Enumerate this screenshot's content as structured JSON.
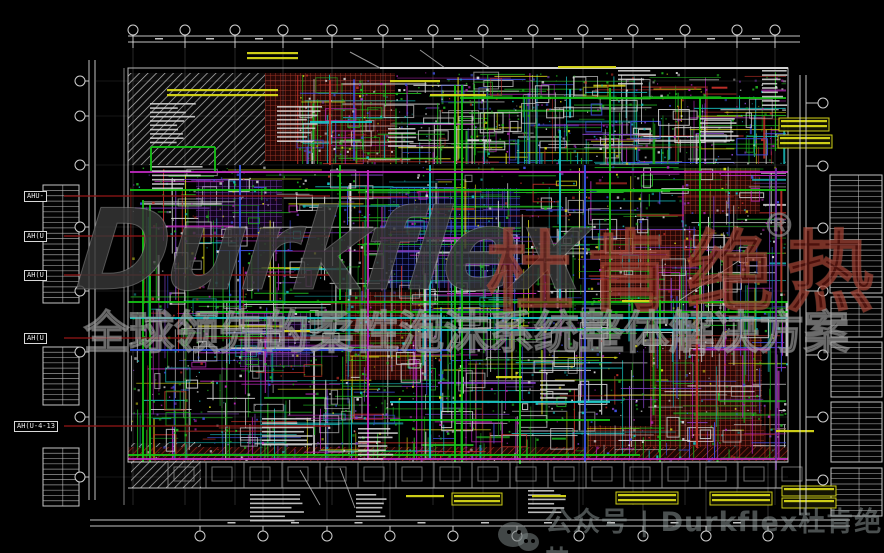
{
  "meta": {
    "width": 884,
    "height": 553,
    "background": "#000000"
  },
  "watermark": {
    "brand_latin": "Durkflex",
    "brand_cjk": "杜肯绝热",
    "registered_mark": "®",
    "slogan": "全球领先的柔性泡沫系统整体解决方案",
    "latin_color": "rgba(55,55,55,0.82)",
    "cjk_color": "rgba(125,28,20,0.60)",
    "slogan_color": "rgba(140,140,140,0.22)"
  },
  "footer": {
    "icon": "wechat-icon",
    "text": "公众号 | Durkflex杜肯绝热",
    "color": "rgba(148,158,158,0.50)"
  },
  "equipment_tags": [
    {
      "text": "AHU-",
      "x": 24,
      "y": 191
    },
    {
      "text": "AH(U",
      "x": 24,
      "y": 231
    },
    {
      "text": "AH(U",
      "x": 24,
      "y": 270
    },
    {
      "text": "AH(U",
      "x": 24,
      "y": 333
    },
    {
      "text": "AH(U-4-13",
      "x": 14,
      "y": 421
    }
  ],
  "grid": {
    "top_x": [
      133,
      185,
      235,
      283,
      332,
      383,
      433,
      483,
      533,
      583,
      633,
      685,
      737,
      775
    ],
    "bottom_x": [
      200,
      263,
      327,
      390,
      453,
      517,
      579,
      643,
      706,
      768
    ],
    "left_y": [
      81,
      116,
      165,
      227,
      291,
      352,
      417,
      477
    ],
    "right_y": [
      103,
      166,
      228,
      291,
      355,
      417,
      480
    ]
  },
  "drawing": {
    "seed": 42,
    "plan": {
      "x1": 128,
      "y1": 68,
      "x2": 788,
      "y2": 462
    },
    "regions": [
      {
        "x": 128,
        "y": 73,
        "w": 137,
        "h": 92,
        "pat": "hatchL"
      },
      {
        "x": 131,
        "y": 443,
        "w": 70,
        "h": 45,
        "pat": "hatchL"
      },
      {
        "x": 265,
        "y": 73,
        "w": 130,
        "h": 88,
        "pat": "gridR"
      },
      {
        "x": 345,
        "y": 292,
        "w": 88,
        "h": 88,
        "pat": "gridR"
      },
      {
        "x": 600,
        "y": 230,
        "w": 100,
        "h": 72,
        "pat": "gridR"
      },
      {
        "x": 650,
        "y": 338,
        "w": 112,
        "h": 110,
        "pat": "gridR"
      },
      {
        "x": 684,
        "y": 168,
        "w": 76,
        "h": 46,
        "pat": "gridR"
      },
      {
        "x": 588,
        "y": 426,
        "w": 176,
        "h": 22,
        "pat": "gridR"
      },
      {
        "x": 128,
        "y": 447,
        "w": 660,
        "h": 14,
        "pat": "hatchR"
      },
      {
        "x": 388,
        "y": 188,
        "w": 132,
        "h": 100,
        "pat": "gridB"
      },
      {
        "x": 196,
        "y": 180,
        "w": 86,
        "h": 58,
        "pat": "gridP"
      },
      {
        "x": 240,
        "y": 312,
        "w": 70,
        "h": 55,
        "pat": "gridP"
      }
    ],
    "pipes": {
      "#15c415": [
        [
          455,
          85,
          455,
          462
        ],
        [
          462,
          85,
          462,
          462
        ],
        [
          143,
          200,
          143,
          462
        ],
        [
          150,
          205,
          150,
          462
        ],
        [
          520,
          300,
          520,
          464
        ],
        [
          610,
          88,
          610,
          340
        ],
        [
          660,
          300,
          660,
          462
        ],
        [
          130,
          190,
          786,
          190
        ],
        [
          128,
          302,
          788,
          302
        ],
        [
          200,
          312,
          788,
          312
        ],
        [
          128,
          455,
          640,
          455
        ],
        [
          390,
          420,
          610,
          420
        ],
        [
          460,
          98,
          786,
          98
        ],
        [
          340,
          165,
          340,
          300
        ],
        [
          700,
          98,
          700,
          300
        ],
        [
          151,
          147,
          215,
          147
        ],
        [
          151,
          147,
          151,
          173
        ],
        [
          215,
          147,
          215,
          173
        ]
      ],
      "#19c8c8": [
        [
          130,
          318,
          788,
          318
        ],
        [
          300,
          330,
          700,
          330
        ],
        [
          430,
          165,
          430,
          460
        ],
        [
          390,
          402,
          610,
          402
        ],
        [
          560,
          130,
          560,
          300
        ],
        [
          310,
          122,
          372,
          122
        ]
      ],
      "#c02ac0": [
        [
          130,
          172,
          788,
          172
        ],
        [
          368,
          170,
          368,
          460
        ],
        [
          380,
          238,
          520,
          238
        ],
        [
          128,
          459,
          788,
          459
        ]
      ],
      "#3858e8": [
        [
          130,
          350,
          450,
          350
        ],
        [
          585,
          165,
          585,
          462
        ],
        [
          240,
          165,
          240,
          310
        ]
      ],
      "#7030a0": [
        [
          776,
          168,
          776,
          470
        ]
      ],
      "#c03028": [
        [
          330,
          80,
          330,
          165
        ],
        [
          697,
          300,
          697,
          448
        ]
      ]
    },
    "mesh": [
      {
        "area": [
          130,
          166,
          656,
          294
        ],
        "lines": 760,
        "rects": 150,
        "speckles": 1250
      },
      {
        "area": [
          296,
          72,
          490,
          92
        ],
        "lines": 290,
        "rects": 62,
        "speckles": 420
      }
    ],
    "tables": [
      {
        "x": 43,
        "y": 185,
        "w": 36,
        "h": 118
      },
      {
        "x": 43,
        "y": 347,
        "w": 36,
        "h": 58
      },
      {
        "x": 43,
        "y": 448,
        "w": 36,
        "h": 58
      },
      {
        "x": 830,
        "y": 175,
        "w": 52,
        "h": 118
      },
      {
        "x": 831,
        "y": 297,
        "w": 51,
        "h": 40
      },
      {
        "x": 831,
        "y": 342,
        "w": 51,
        "h": 55
      },
      {
        "x": 831,
        "y": 402,
        "w": 51,
        "h": 60
      },
      {
        "x": 831,
        "y": 468,
        "w": 51,
        "h": 48
      }
    ],
    "text_sketches": [
      {
        "x": 150,
        "y": 103,
        "w": 46,
        "rows": 10
      },
      {
        "x": 277,
        "y": 106,
        "w": 46,
        "rows": 9
      },
      {
        "x": 152,
        "y": 166,
        "w": 56,
        "rows": 6
      },
      {
        "x": 388,
        "y": 128,
        "w": 30,
        "rows": 5
      },
      {
        "x": 700,
        "y": 118,
        "w": 42,
        "rows": 6
      },
      {
        "x": 618,
        "y": 70,
        "w": 40,
        "rows": 4
      },
      {
        "x": 262,
        "y": 418,
        "w": 55,
        "rows": 7
      },
      {
        "x": 358,
        "y": 428,
        "w": 40,
        "rows": 8
      },
      {
        "x": 250,
        "y": 494,
        "w": 58,
        "rows": 7
      },
      {
        "x": 356,
        "y": 494,
        "w": 36,
        "rows": 6
      },
      {
        "x": 528,
        "y": 490,
        "w": 44,
        "rows": 6
      },
      {
        "x": 762,
        "y": 70,
        "w": 26,
        "rows": 9
      },
      {
        "x": 540,
        "y": 380,
        "w": 40,
        "rows": 5
      }
    ],
    "annotations": [
      {
        "x": 245,
        "y": 50,
        "w": 55,
        "h": 12,
        "boxed": 0
      },
      {
        "x": 165,
        "y": 87,
        "w": 115,
        "h": 13,
        "boxed": 0
      },
      {
        "x": 388,
        "y": 78,
        "w": 54,
        "h": 11,
        "boxed": 0
      },
      {
        "x": 428,
        "y": 92,
        "w": 60,
        "h": 11,
        "boxed": 0
      },
      {
        "x": 556,
        "y": 64,
        "w": 62,
        "h": 10,
        "boxed": 0
      },
      {
        "x": 779,
        "y": 118,
        "w": 50,
        "h": 13,
        "boxed": 1
      },
      {
        "x": 778,
        "y": 135,
        "w": 54,
        "h": 13,
        "boxed": 1
      },
      {
        "x": 774,
        "y": 428,
        "w": 42,
        "h": 11,
        "boxed": 0
      },
      {
        "x": 782,
        "y": 486,
        "w": 54,
        "h": 10,
        "boxed": 1
      },
      {
        "x": 782,
        "y": 498,
        "w": 54,
        "h": 10,
        "boxed": 1
      },
      {
        "x": 404,
        "y": 493,
        "w": 42,
        "h": 11,
        "boxed": 0
      },
      {
        "x": 452,
        "y": 493,
        "w": 50,
        "h": 12,
        "boxed": 1
      },
      {
        "x": 530,
        "y": 493,
        "w": 38,
        "h": 11,
        "boxed": 0
      },
      {
        "x": 616,
        "y": 492,
        "w": 62,
        "h": 12,
        "boxed": 1
      },
      {
        "x": 710,
        "y": 492,
        "w": 62,
        "h": 13,
        "boxed": 1
      },
      {
        "x": 494,
        "y": 374,
        "w": 30,
        "h": 9,
        "boxed": 0
      },
      {
        "x": 282,
        "y": 328,
        "w": 30,
        "h": 9,
        "boxed": 0
      },
      {
        "x": 620,
        "y": 298,
        "w": 34,
        "h": 9,
        "boxed": 0
      }
    ],
    "corridor": {
      "x1": 128,
      "x2": 788,
      "y1": 462,
      "y2": 488,
      "step": 38,
      "color": "#9a9a9a"
    },
    "leader_color": "#8c1616",
    "line_color": "#d8d8d8",
    "yellow": "#d8d818"
  }
}
